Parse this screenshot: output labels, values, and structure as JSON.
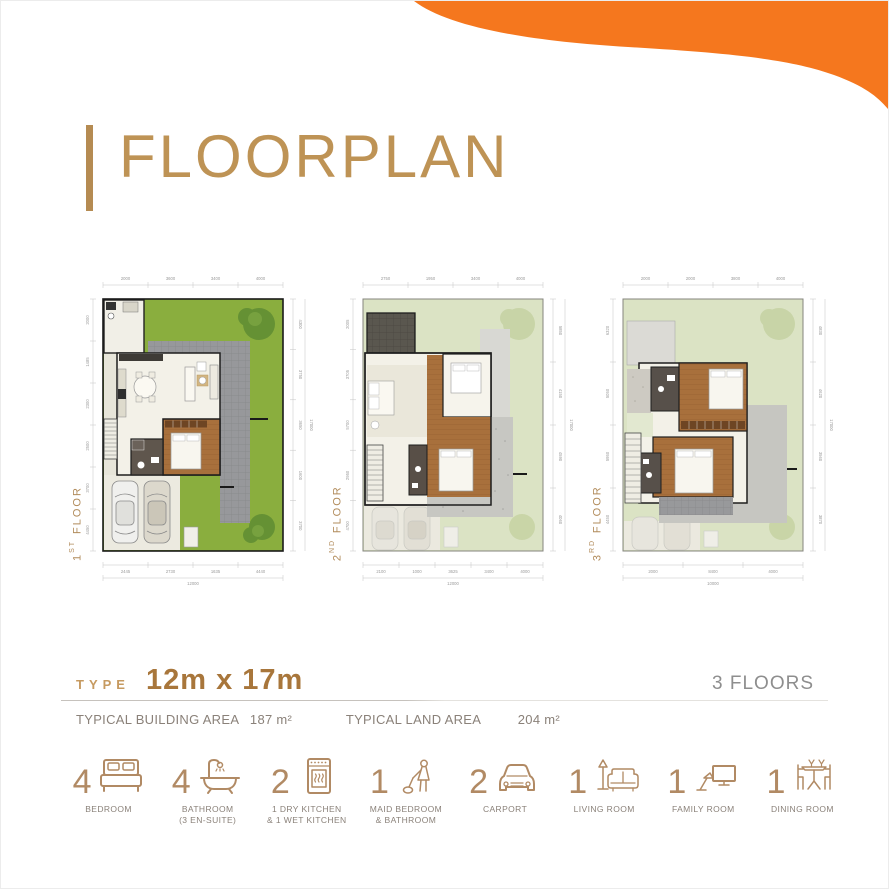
{
  "colors": {
    "orange": "#F5771E",
    "gold_title": "#BE9355",
    "gold_bar": "#B58B52",
    "bronze_icons": "#B18A64",
    "type_gold": "#C69A60",
    "type_value_bronze": "#A8763B",
    "gray_text": "#8A8179"
  },
  "header": {
    "title": "FLOORPLAN"
  },
  "plans": [
    {
      "label_num": "1",
      "label_sup": "ST",
      "label_word": "FLOOR",
      "dims_top": [
        "2000",
        "3600",
        "3400",
        "4000"
      ],
      "dims_bottom": [
        "2445",
        "2730",
        "1635",
        "4440"
      ],
      "bottom_total": "12000",
      "dims_right": [
        "4300",
        "3750",
        "3650",
        "1600",
        "3700"
      ],
      "right_total": "17000",
      "dims_left": [
        "2000",
        "1485",
        "2300",
        "2500",
        "3700",
        "4450"
      ]
    },
    {
      "label_num": "2",
      "label_sup": "ND",
      "label_word": "FLOOR",
      "dims_top": [
        "2750",
        "1950",
        "3400",
        "4000"
      ],
      "dims_bottom": [
        "2100",
        "1000",
        "3625",
        "3400",
        "4000"
      ],
      "bottom_total": "12000",
      "dims_right": [
        "5850",
        "4150",
        "4590",
        "4060"
      ],
      "right_total": "17000",
      "dims_left": [
        "2005",
        "3705",
        "5700",
        "2950",
        "4700"
      ]
    },
    {
      "label_num": "3",
      "label_sup": "RD",
      "label_word": "FLOOR",
      "dims_top": [
        "2000",
        "2000",
        "3800",
        "4000"
      ],
      "dims_bottom": [
        "2000",
        "8400",
        "4000"
      ],
      "bottom_total": "10000",
      "dims_right": [
        "4830",
        "4620",
        "3560",
        "3870"
      ],
      "right_total": "17000",
      "dims_left": [
        "6320",
        "5050",
        "5950",
        "4450"
      ]
    }
  ],
  "spec": {
    "type_label": "TYPE",
    "type_value": "12m x 17m",
    "floors_label": "3 FLOORS",
    "building_area_label": "TYPICAL BUILDING AREA",
    "building_area_value": "187 m²",
    "land_area_label": "TYPICAL LAND AREA",
    "land_area_value": "204 m²"
  },
  "features": [
    {
      "count": "4",
      "icon": "bed-icon",
      "label1": "BEDROOM",
      "label2": ""
    },
    {
      "count": "4",
      "icon": "bathtub-icon",
      "label1": "BATHROOM",
      "label2": "(3 EN-SUITE)"
    },
    {
      "count": "2",
      "icon": "oven-icon",
      "label1": "1 DRY KITCHEN",
      "label2": "& 1 WET KITCHEN"
    },
    {
      "count": "1",
      "icon": "maid-icon",
      "label1": "MAID BEDROOM",
      "label2": "& BATHROOM"
    },
    {
      "count": "2",
      "icon": "car-icon",
      "label1": "CARPORT",
      "label2": ""
    },
    {
      "count": "1",
      "icon": "sofa-icon",
      "label1": "LIVING ROOM",
      "label2": ""
    },
    {
      "count": "1",
      "icon": "tv-icon",
      "label1": "FAMILY ROOM",
      "label2": ""
    },
    {
      "count": "1",
      "icon": "dining-icon",
      "label1": "DINING ROOM",
      "label2": ""
    }
  ]
}
